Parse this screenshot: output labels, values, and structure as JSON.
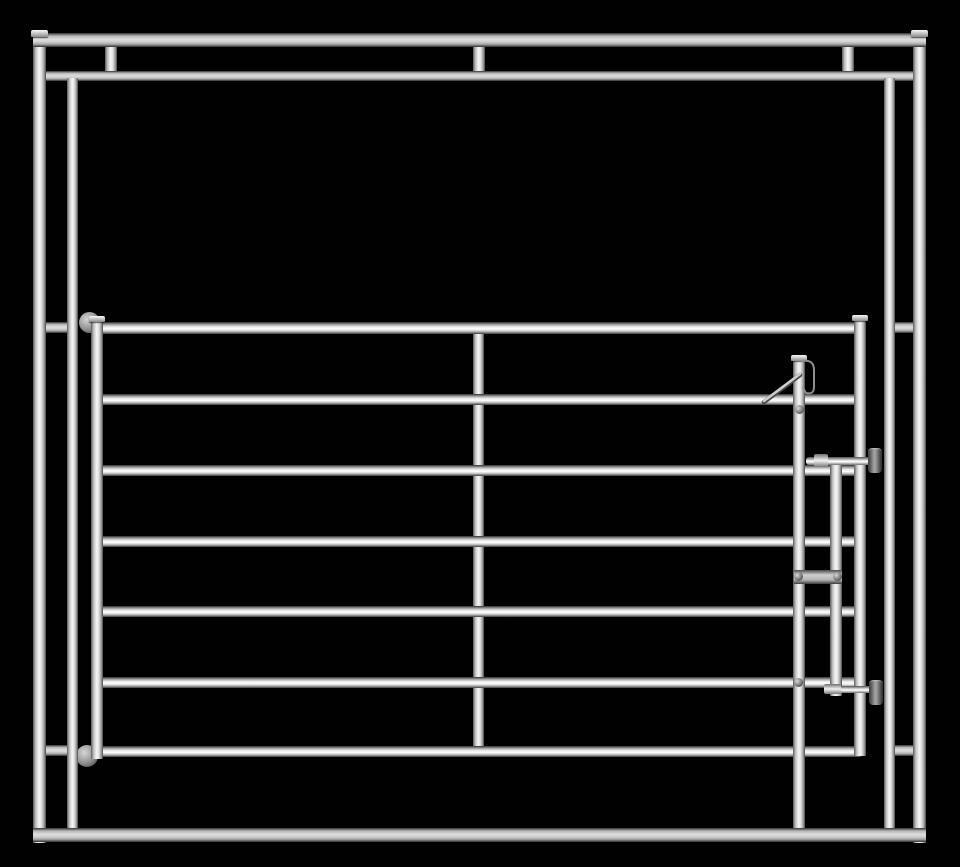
{
  "meta": {
    "subject": "galvanized-steel-livestock-corral-panel-with-slide-latch-gate",
    "canvas": {
      "width": 960,
      "height": 867
    },
    "background_color": "#010101",
    "material_colors": {
      "tube_highlight": "#ffffff",
      "tube_mid": "#d2d2d2",
      "tube_shadow_edge": "#2e2e2e",
      "hardware_dark": "#353535",
      "hardware_mid": "#8e8e8e"
    }
  },
  "scene": {
    "parts": [
      {
        "name": "header-link-left",
        "type": "vtube",
        "x": 105,
        "y": 45,
        "w": 12,
        "h": 28,
        "z": 10
      },
      {
        "name": "header-link-center",
        "type": "vtube",
        "x": 473,
        "y": 45,
        "w": 12,
        "h": 28,
        "z": 10
      },
      {
        "name": "header-link-right",
        "type": "vtube",
        "x": 842,
        "y": 45,
        "w": 12,
        "h": 28,
        "z": 10
      },
      {
        "name": "side-link-upper-left",
        "type": "htube-flat",
        "x": 44,
        "y": 322,
        "w": 24,
        "h": 11,
        "z": 10
      },
      {
        "name": "side-link-upper-right",
        "type": "htube-flat",
        "x": 894,
        "y": 322,
        "w": 20,
        "h": 11,
        "z": 10
      },
      {
        "name": "side-link-lower-left",
        "type": "htube-flat",
        "x": 44,
        "y": 745,
        "w": 24,
        "h": 11,
        "z": 10
      },
      {
        "name": "side-link-lower-right",
        "type": "htube-flat",
        "x": 894,
        "y": 745,
        "w": 20,
        "h": 11,
        "z": 10
      },
      {
        "name": "gate-center-brace",
        "type": "vtube",
        "x": 473,
        "y": 328,
        "w": 11,
        "h": 424,
        "z": 15
      },
      {
        "name": "frame-top-rail-lower",
        "type": "htube-flat",
        "x": 45,
        "y": 71,
        "w": 868,
        "h": 10,
        "z": 20
      },
      {
        "name": "gate-rail-1",
        "type": "htube",
        "x": 96,
        "y": 322,
        "w": 765,
        "h": 12,
        "z": 20
      },
      {
        "name": "gate-rail-2",
        "type": "htube",
        "x": 96,
        "y": 394,
        "w": 765,
        "h": 11,
        "z": 20
      },
      {
        "name": "gate-rail-3",
        "type": "htube",
        "x": 96,
        "y": 465,
        "w": 765,
        "h": 11,
        "z": 20
      },
      {
        "name": "gate-rail-4",
        "type": "htube",
        "x": 96,
        "y": 536,
        "w": 765,
        "h": 11,
        "z": 20
      },
      {
        "name": "gate-rail-5",
        "type": "htube",
        "x": 96,
        "y": 606,
        "w": 765,
        "h": 11,
        "z": 20
      },
      {
        "name": "gate-rail-6",
        "type": "htube",
        "x": 96,
        "y": 677,
        "w": 765,
        "h": 11,
        "z": 20
      },
      {
        "name": "gate-rail-7",
        "type": "htube",
        "x": 96,
        "y": 746,
        "w": 765,
        "h": 11,
        "z": 20
      },
      {
        "name": "gate-hinge-top",
        "type": "hinge",
        "x": 79,
        "y": 312,
        "w": 21,
        "h": 21,
        "z": 25
      },
      {
        "name": "gate-hinge-bottom",
        "type": "hinge",
        "x": 76,
        "y": 745,
        "w": 22,
        "h": 22,
        "z": 25
      },
      {
        "name": "frame-inner-post-left",
        "type": "vtube",
        "x": 67,
        "y": 78,
        "w": 11,
        "h": 750,
        "z": 28
      },
      {
        "name": "frame-inner-post-right",
        "type": "vtube",
        "x": 884,
        "y": 78,
        "w": 11,
        "h": 750,
        "z": 28
      },
      {
        "name": "frame-outer-post-left",
        "type": "vtube",
        "x": 33,
        "y": 34,
        "w": 13,
        "h": 809,
        "z": 30
      },
      {
        "name": "frame-outer-post-right",
        "type": "vtube",
        "x": 913,
        "y": 34,
        "w": 13,
        "h": 809,
        "z": 30
      },
      {
        "name": "gate-stile-left",
        "type": "vtube",
        "x": 91,
        "y": 319,
        "w": 12,
        "h": 440,
        "z": 30
      },
      {
        "name": "gate-end-right",
        "type": "vtube",
        "x": 854,
        "y": 318,
        "w": 12,
        "h": 438,
        "z": 30
      },
      {
        "name": "latch-drop-bar",
        "type": "vtube",
        "x": 793,
        "y": 357,
        "w": 12,
        "h": 481,
        "z": 31
      },
      {
        "name": "latch-slide-bar",
        "type": "vtube",
        "x": 830,
        "y": 458,
        "w": 12,
        "h": 238,
        "z": 31
      },
      {
        "name": "frame-top-rail",
        "type": "htube-flat",
        "x": 33,
        "y": 33,
        "w": 893,
        "h": 14,
        "z": 35
      },
      {
        "name": "frame-bottom-rail",
        "type": "htube-flat",
        "x": 33,
        "y": 828,
        "w": 893,
        "h": 14,
        "z": 35
      },
      {
        "name": "post-cap-left",
        "type": "cap",
        "x": 31,
        "y": 30,
        "w": 17,
        "h": 7,
        "z": 40
      },
      {
        "name": "post-cap-right",
        "type": "cap",
        "x": 911,
        "y": 30,
        "w": 17,
        "h": 7,
        "z": 40
      },
      {
        "name": "gate-stile-cap",
        "type": "cap",
        "x": 89,
        "y": 316,
        "w": 16,
        "h": 6,
        "z": 40
      },
      {
        "name": "gate-end-cap",
        "type": "cap",
        "x": 852,
        "y": 315,
        "w": 16,
        "h": 6,
        "z": 40
      },
      {
        "name": "latch-drop-bar-cap",
        "type": "cap",
        "x": 791,
        "y": 355,
        "w": 16,
        "h": 6,
        "z": 40
      },
      {
        "name": "latch-rod-top",
        "type": "rod",
        "x": 806,
        "y": 457,
        "w": 70,
        "h": 8,
        "z": 44
      },
      {
        "name": "latch-rod-bottom",
        "type": "rod",
        "x": 830,
        "y": 686,
        "w": 46,
        "h": 7,
        "z": 44
      },
      {
        "name": "latch-bracket",
        "type": "plate",
        "x": 794,
        "y": 570,
        "w": 48,
        "h": 14,
        "z": 45
      },
      {
        "name": "latch-collar-top",
        "type": "collar",
        "x": 814,
        "y": 454,
        "w": 14,
        "h": 13,
        "z": 46
      },
      {
        "name": "latch-collar-bottom",
        "type": "collar",
        "x": 824,
        "y": 684,
        "w": 17,
        "h": 10,
        "z": 46
      },
      {
        "name": "latch-knob-top",
        "type": "knob",
        "x": 868,
        "y": 448,
        "w": 14,
        "h": 25,
        "z": 50
      },
      {
        "name": "latch-knob-bottom",
        "type": "knob",
        "x": 869,
        "y": 680,
        "w": 14,
        "h": 25,
        "z": 50
      },
      {
        "name": "bolt-rail2",
        "type": "bolt",
        "x": 795,
        "y": 405,
        "w": 9,
        "h": 9,
        "z": 50
      },
      {
        "name": "bolt-bracket-left",
        "type": "bolt",
        "x": 794,
        "y": 572,
        "w": 9,
        "h": 9,
        "z": 50
      },
      {
        "name": "bolt-bracket-right",
        "type": "bolt",
        "x": 833,
        "y": 572,
        "w": 9,
        "h": 9,
        "z": 50
      },
      {
        "name": "bolt-rail6",
        "type": "bolt",
        "x": 794,
        "y": 678,
        "w": 9,
        "h": 9,
        "z": 50
      },
      {
        "name": "latch-hook",
        "type": "svg",
        "x": 799,
        "y": 356,
        "w": 22,
        "h": 42,
        "z": 50,
        "paths": [
          {
            "d": "M3,5 Q15,3 15,14 L15,31 Q15,39 7,37 L4,32",
            "stroke": "#8f8f8f",
            "width": 2
          }
        ]
      },
      {
        "name": "latch-spring-arm",
        "type": "svg",
        "x": 762,
        "y": 371,
        "w": 40,
        "h": 32,
        "z": 50,
        "paths": [
          {
            "d": "M2,31 L38,4",
            "stroke": "#4a4a4a",
            "width": 4.5
          },
          {
            "d": "M2,30 L38,3",
            "stroke": "#cfcfcf",
            "width": 2.5
          }
        ]
      }
    ]
  }
}
